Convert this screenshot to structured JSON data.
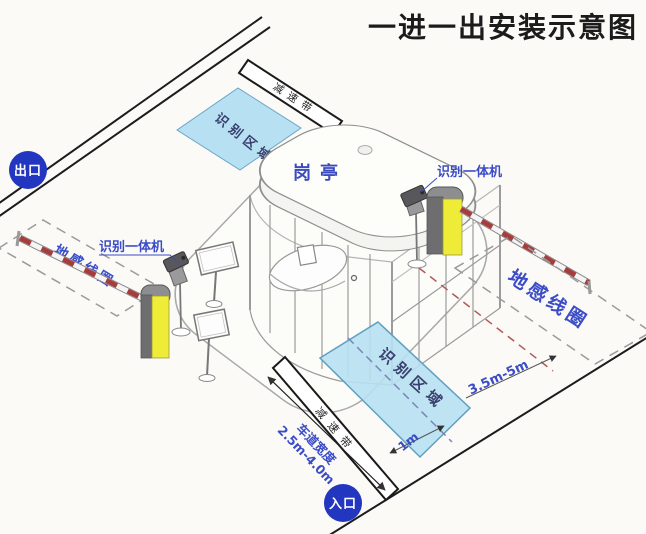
{
  "title": "一进一出安装示意图",
  "markers": {
    "exit": "出口",
    "entry": "入口"
  },
  "booth": {
    "label": "岗亭"
  },
  "devices": {
    "left_camera_label": "识别一体机",
    "right_camera_label": "识别一体机"
  },
  "zones": {
    "top_recognition": "识别区域",
    "bottom_recognition": "识别区域",
    "left_loop": "地感线圈",
    "right_loop": "地感线圈",
    "top_speed_bump": "减速带",
    "bottom_speed_bump": "减速带"
  },
  "dimensions": {
    "lane_width_label": "车道宽度",
    "lane_width_value": "2.5m-4.0m",
    "loop_distance": "3.5m-5m",
    "centerline_offset": "1m"
  },
  "colors": {
    "marker_blue": "#2236c0",
    "label_blue": "#3b4cc8",
    "zone_fill": "#b7e0f2",
    "zone_stroke": "#5f9fc2",
    "zone_text": "#39406e",
    "barrier_yellow": "#efec38",
    "arm_red": "#a63c3c",
    "line_black": "#1a1a1a",
    "title_color": "#1b1b1b"
  }
}
